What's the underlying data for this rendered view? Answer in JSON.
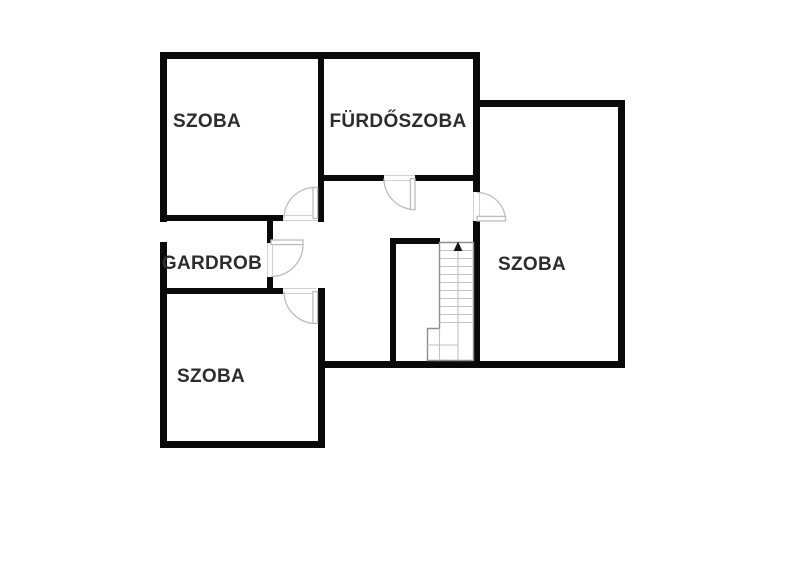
{
  "diagram": {
    "type": "floor-plan",
    "rooms": [
      {
        "id": "room-top-left",
        "label": "SZOBA"
      },
      {
        "id": "bathroom",
        "label": "FÜRDŐSZOBA"
      },
      {
        "id": "wardrobe",
        "label": "GARDROB"
      },
      {
        "id": "room-bottom-left",
        "label": "SZOBA"
      },
      {
        "id": "room-right",
        "label": "SZOBA"
      }
    ],
    "stairs": {
      "direction": "up"
    },
    "doors_count": 5,
    "colors": {
      "wall": "#0a0a0a",
      "door": "#bdbdbd",
      "stair_outline": "#8f8f8f",
      "stair_tread": "#c2c2c2",
      "background": "#ffffff",
      "label_text": "#2d2d2d"
    }
  }
}
